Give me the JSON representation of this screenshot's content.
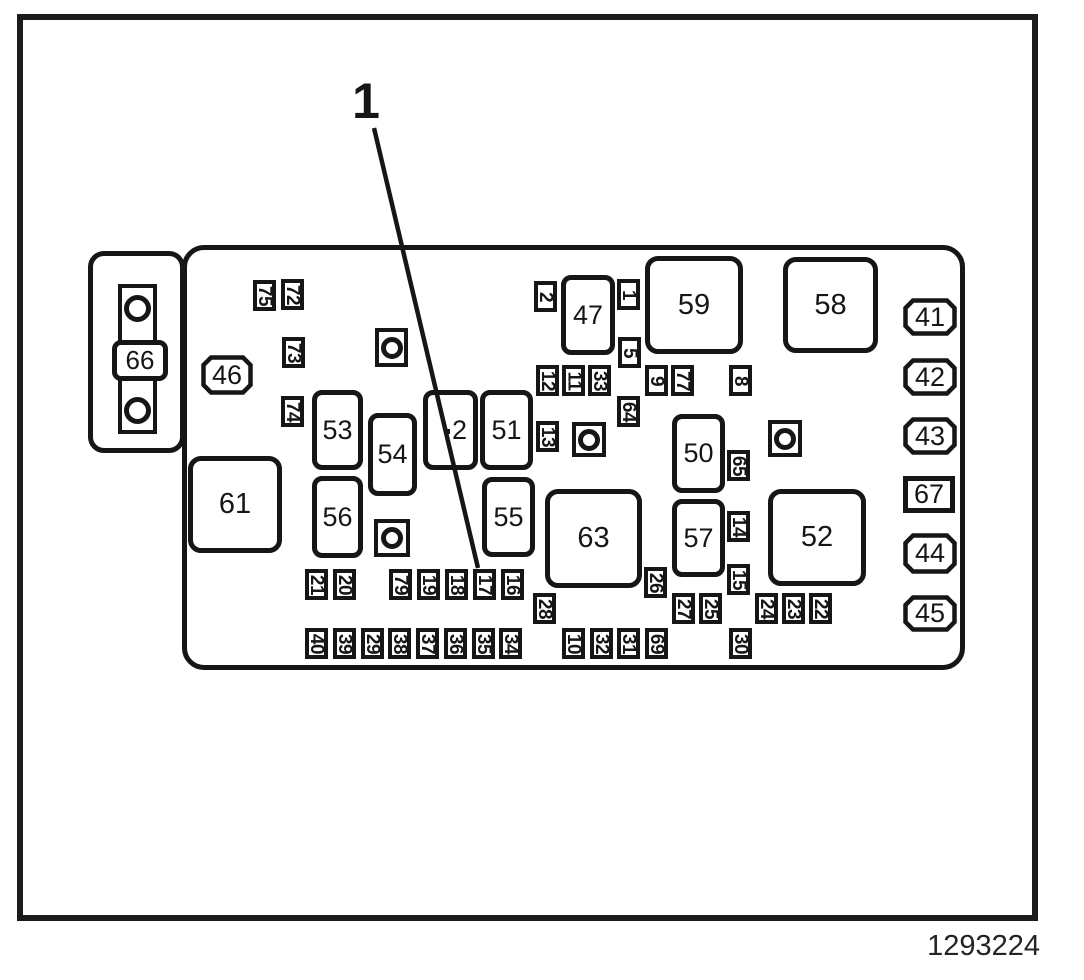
{
  "part_number": "1293224",
  "callout": {
    "label": "1",
    "line": {
      "x1": 374,
      "y1": 128,
      "x2": 478,
      "y2": 568
    }
  },
  "colors": {
    "ink": "#161616",
    "background": "#ffffff"
  },
  "components": {
    "megafuse": {
      "label": "66"
    },
    "small_fuses": [
      {
        "label": "75",
        "x": 253,
        "y": 280
      },
      {
        "label": "72",
        "x": 281,
        "y": 279
      },
      {
        "label": "73",
        "x": 282,
        "y": 337
      },
      {
        "label": "74",
        "x": 281,
        "y": 396
      },
      {
        "label": "2",
        "x": 534,
        "y": 281
      },
      {
        "label": "1",
        "x": 617,
        "y": 279
      },
      {
        "label": "5",
        "x": 618,
        "y": 337
      },
      {
        "label": "12",
        "x": 536,
        "y": 365
      },
      {
        "label": "11",
        "x": 562,
        "y": 365
      },
      {
        "label": "33",
        "x": 588,
        "y": 365
      },
      {
        "label": "9",
        "x": 645,
        "y": 365
      },
      {
        "label": "77",
        "x": 671,
        "y": 365
      },
      {
        "label": "8",
        "x": 729,
        "y": 365
      },
      {
        "label": "64",
        "x": 617,
        "y": 396
      },
      {
        "label": "13",
        "x": 536,
        "y": 421
      },
      {
        "label": "65",
        "x": 727,
        "y": 450
      },
      {
        "label": "14",
        "x": 727,
        "y": 511
      },
      {
        "label": "15",
        "x": 727,
        "y": 564
      },
      {
        "label": "26",
        "x": 644,
        "y": 567
      },
      {
        "label": "21",
        "x": 305,
        "y": 569
      },
      {
        "label": "20",
        "x": 333,
        "y": 569
      },
      {
        "label": "79",
        "x": 389,
        "y": 569
      },
      {
        "label": "19",
        "x": 417,
        "y": 569
      },
      {
        "label": "18",
        "x": 445,
        "y": 569
      },
      {
        "label": "17",
        "x": 473,
        "y": 569
      },
      {
        "label": "16",
        "x": 501,
        "y": 569
      },
      {
        "label": "28",
        "x": 533,
        "y": 593
      },
      {
        "label": "27",
        "x": 672,
        "y": 593
      },
      {
        "label": "25",
        "x": 699,
        "y": 593
      },
      {
        "label": "24",
        "x": 755,
        "y": 593
      },
      {
        "label": "23",
        "x": 782,
        "y": 593
      },
      {
        "label": "22",
        "x": 809,
        "y": 593
      },
      {
        "label": "40",
        "x": 305,
        "y": 628
      },
      {
        "label": "39",
        "x": 333,
        "y": 628
      },
      {
        "label": "29",
        "x": 361,
        "y": 628
      },
      {
        "label": "38",
        "x": 388,
        "y": 628
      },
      {
        "label": "37",
        "x": 416,
        "y": 628
      },
      {
        "label": "36",
        "x": 444,
        "y": 628
      },
      {
        "label": "35",
        "x": 472,
        "y": 628
      },
      {
        "label": "34",
        "x": 499,
        "y": 628
      },
      {
        "label": "10",
        "x": 562,
        "y": 628
      },
      {
        "label": "32",
        "x": 590,
        "y": 628
      },
      {
        "label": "31",
        "x": 617,
        "y": 628
      },
      {
        "label": "69",
        "x": 645,
        "y": 628
      },
      {
        "label": "30",
        "x": 729,
        "y": 628
      }
    ],
    "relays": [
      {
        "label": "47",
        "x": 561,
        "y": 275,
        "w": 54,
        "h": 80
      },
      {
        "label": "59",
        "x": 645,
        "y": 256,
        "w": 98,
        "h": 98
      },
      {
        "label": "58",
        "x": 783,
        "y": 257,
        "w": 95,
        "h": 96
      },
      {
        "label": "53",
        "x": 312,
        "y": 390,
        "w": 51,
        "h": 80
      },
      {
        "label": "54",
        "x": 368,
        "y": 413,
        "w": 49,
        "h": 83
      },
      {
        "label": "2",
        "x": 423,
        "y": 390,
        "w": 55,
        "h": 80,
        "dx": 9
      },
      {
        "label": "51",
        "x": 480,
        "y": 390,
        "w": 53,
        "h": 80
      },
      {
        "label": "50",
        "x": 672,
        "y": 414,
        "w": 53,
        "h": 79
      },
      {
        "label": "61",
        "x": 188,
        "y": 456,
        "w": 94,
        "h": 97
      },
      {
        "label": "56",
        "x": 312,
        "y": 476,
        "w": 51,
        "h": 82
      },
      {
        "label": "55",
        "x": 482,
        "y": 477,
        "w": 53,
        "h": 80
      },
      {
        "label": "63",
        "x": 545,
        "y": 489,
        "w": 97,
        "h": 99
      },
      {
        "label": "57",
        "x": 672,
        "y": 499,
        "w": 53,
        "h": 78
      },
      {
        "label": "52",
        "x": 768,
        "y": 489,
        "w": 98,
        "h": 97
      }
    ],
    "notched_fuses": [
      {
        "label": "46",
        "x": 201,
        "y": 355,
        "w": 52,
        "h": 40
      },
      {
        "label": "41",
        "x": 903,
        "y": 298,
        "w": 54,
        "h": 38
      },
      {
        "label": "42",
        "x": 903,
        "y": 358,
        "w": 54,
        "h": 38
      },
      {
        "label": "43",
        "x": 903,
        "y": 417,
        "w": 54,
        "h": 38
      },
      {
        "label": "44",
        "x": 903,
        "y": 533,
        "w": 54,
        "h": 41
      },
      {
        "label": "45",
        "x": 903,
        "y": 595,
        "w": 54,
        "h": 37
      }
    ],
    "plain_fuses": [
      {
        "label": "67",
        "x": 903,
        "y": 476,
        "w": 52,
        "h": 37
      }
    ],
    "bolts": [
      {
        "x": 375,
        "y": 328,
        "w": 33,
        "h": 39
      },
      {
        "x": 374,
        "y": 519,
        "w": 36,
        "h": 38
      },
      {
        "x": 572,
        "y": 422,
        "w": 34,
        "h": 35
      },
      {
        "x": 768,
        "y": 420,
        "w": 34,
        "h": 37
      }
    ]
  }
}
